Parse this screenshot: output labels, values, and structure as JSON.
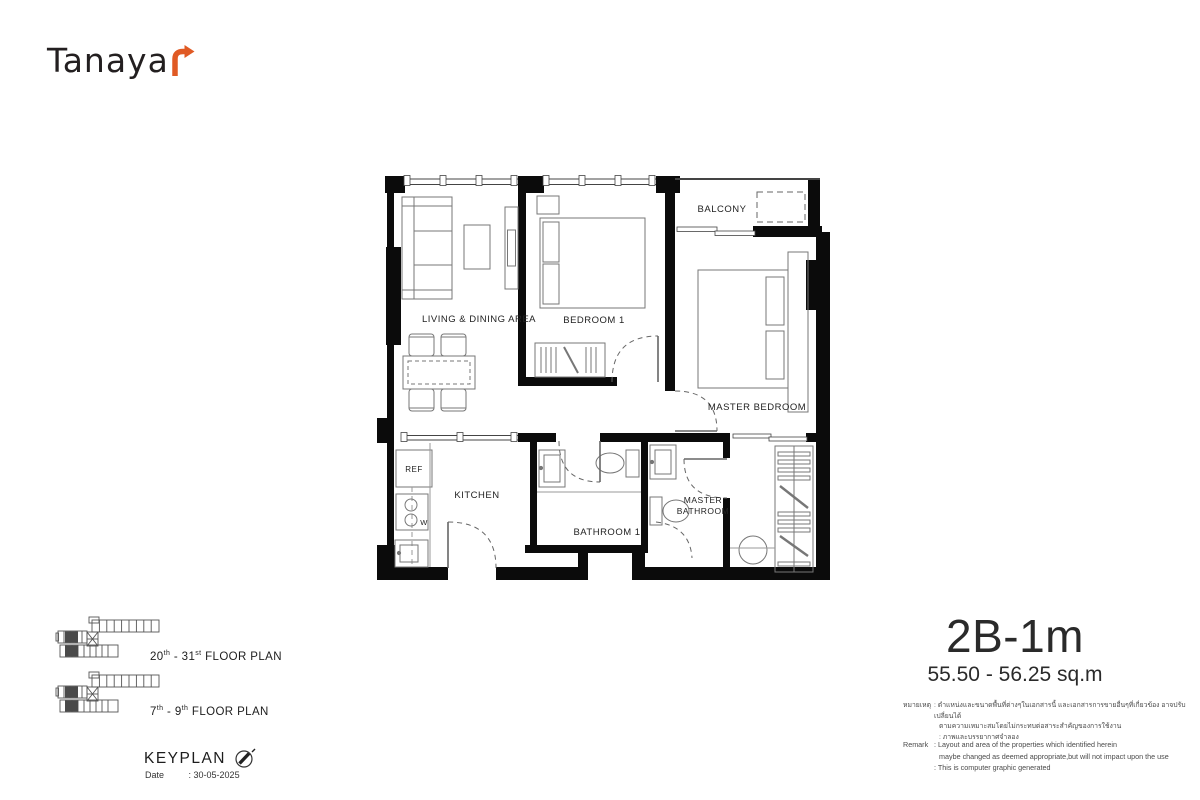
{
  "logo": {
    "text": "Tanaya",
    "arrow_color": "#E05A24"
  },
  "unit": {
    "name": "2B-1m",
    "area": "55.50 - 56.25 sq.m"
  },
  "floor_plan": {
    "rooms": {
      "living_dining": "LIVING & DINING AREA",
      "bedroom1": "BEDROOM 1",
      "balcony": "BALCONY",
      "master_bedroom": "MASTER BEDROOM",
      "kitchen": "KITCHEN",
      "bathroom1": "BATHROOM 1",
      "master_bathroom_line1": "MASTER",
      "master_bathroom_line2": "BATHROOM",
      "ref": "REF",
      "washer": "W"
    }
  },
  "keyplans": [
    {
      "num": "20",
      "sup1": "th",
      "mid": " - 31",
      "sup2": "st",
      "rest": " FLOOR PLAN"
    },
    {
      "num": "7",
      "sup1": "th",
      "mid": " - 9",
      "sup2": "th",
      "rest": " FLOOR PLAN"
    }
  ],
  "keyplan_section": {
    "title": "KEYPLAN",
    "date_label": "Date",
    "date_value": ": 30-05-2025"
  },
  "remark_thai": {
    "label": "หมายเหตุ",
    "lines": [
      ": ตำแหน่งและขนาดพื้นที่ต่างๆในเอกสารนี้ และเอกสารการขายอื่นๆที่เกี่ยวข้อง อาจปรับเปลี่ยนได้",
      "ตามความเหมาะสมโดยไม่กระทบต่อสาระสำคัญของการใช้งาน",
      ": ภาพและบรรยากาศจำลอง"
    ]
  },
  "remark_en": {
    "label": "Remark",
    "lines": [
      ": Layout and area of the properties which identified herein",
      "maybe changed as deemed appropriate,but will not impact upon the use",
      ": This is computer graphic generated"
    ]
  },
  "colors": {
    "accent": "#E05A24",
    "wall": "#0b0b0b",
    "highlight_unit": "#4a4a4a"
  }
}
